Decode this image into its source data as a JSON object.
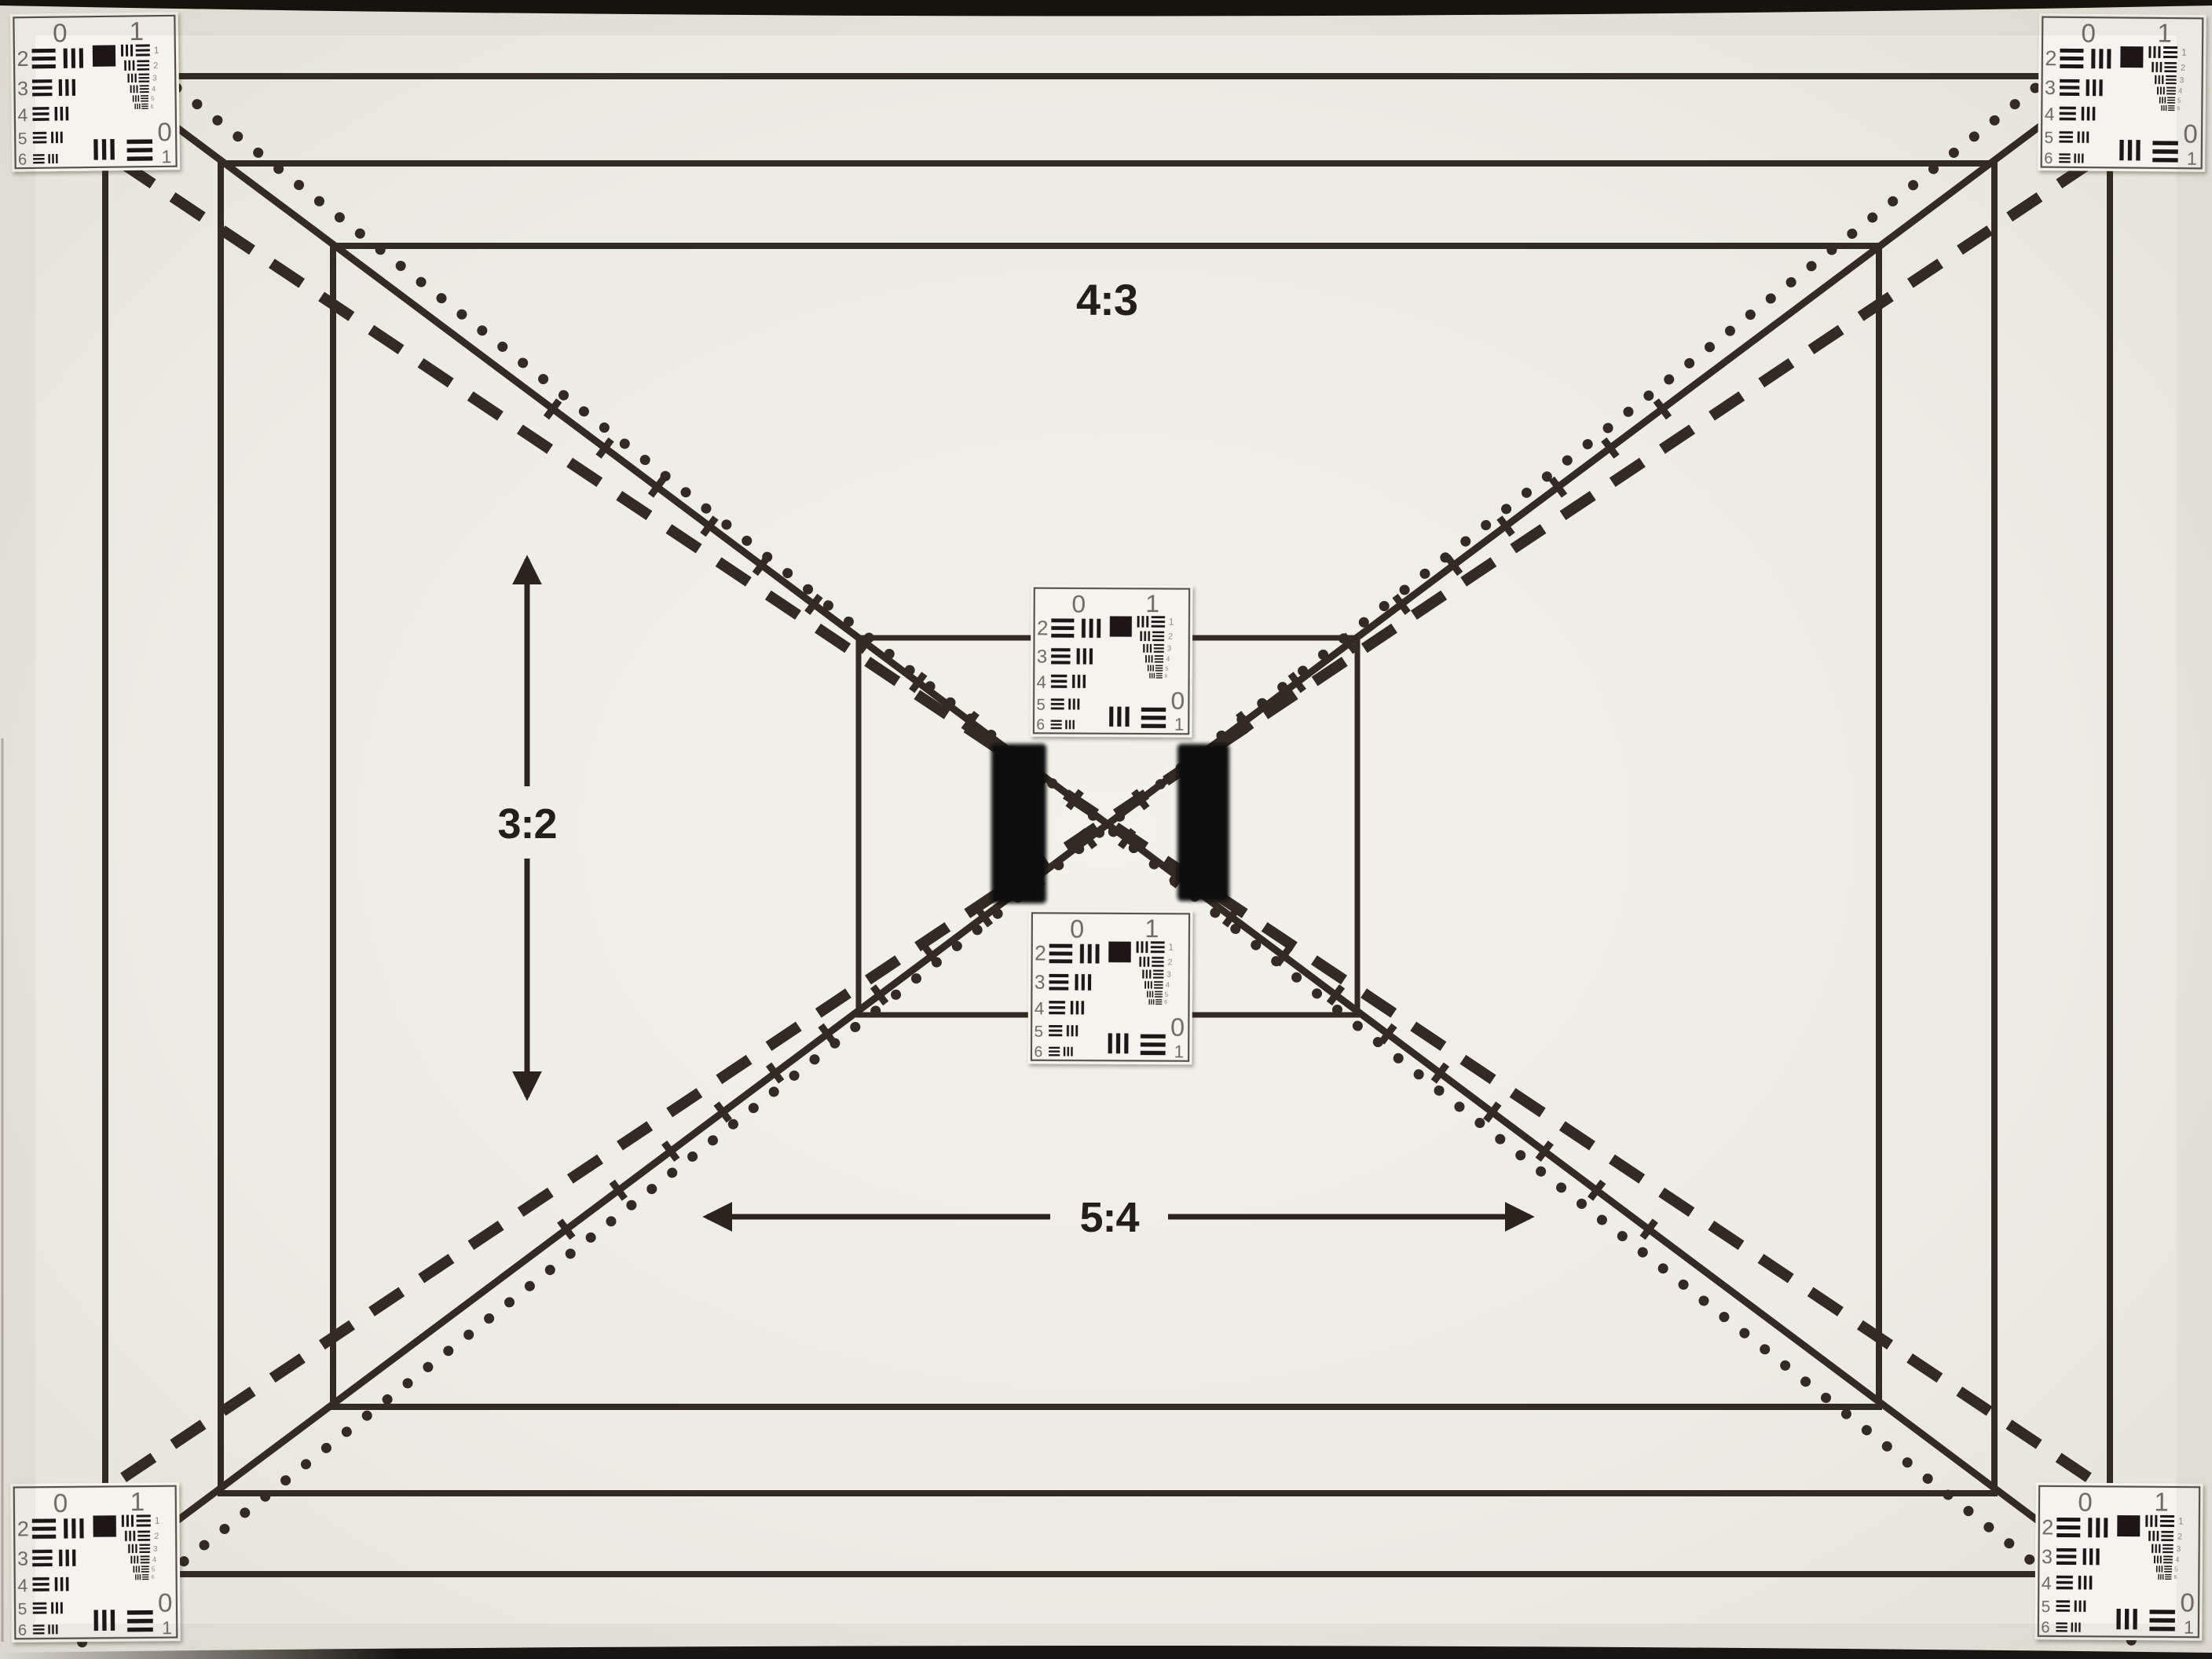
{
  "page": {
    "title": "Photographed lens test chart with USAF-1951 resolution targets, format frames and diagonals"
  },
  "labels": {
    "aspect_top": "4:3",
    "aspect_left": "3:2",
    "aspect_bottom": "5:4"
  },
  "usaf": {
    "top_numbers": [
      "0",
      "1"
    ],
    "row_labels": [
      "2",
      "3",
      "4",
      "5",
      "6"
    ],
    "mini_labels": [
      "1",
      "2",
      "3",
      "4",
      "5",
      "6"
    ],
    "corner_numbers": [
      "0",
      "1"
    ]
  },
  "colors": {
    "paper_center": "#f2f1ea",
    "paper_edge": "#e2e0d5",
    "ink": "#332a22",
    "label_ink": "#241e18",
    "velcro_patch": "#0d0a08",
    "target_card": "#f4f3ed",
    "target_frame": "#56504a",
    "target_bars": "#1c1712",
    "target_numerals": "#6f6a62"
  }
}
